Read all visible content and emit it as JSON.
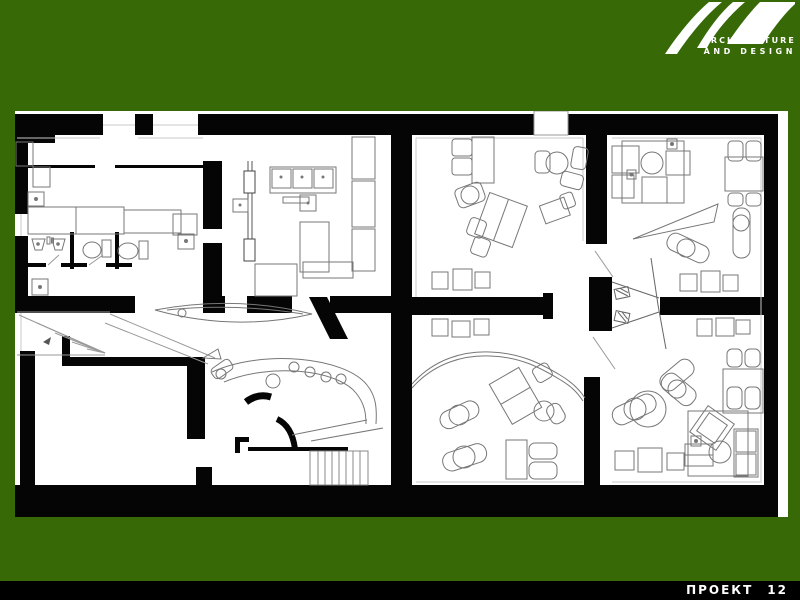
{
  "slide": {
    "background_color": "#376A07",
    "logo": {
      "line1": "ARCHITECTURE",
      "line2": "AND DESIGN",
      "color": "#ffffff"
    },
    "footer": {
      "label": "ПРОЕКТ",
      "number": "12",
      "bar_color": "#000000",
      "text_color": "#ffffff"
    },
    "floor_plan": {
      "wall_color": "#050505",
      "floor_color": "#ffffff",
      "furniture_line_color": "#777777"
    }
  }
}
